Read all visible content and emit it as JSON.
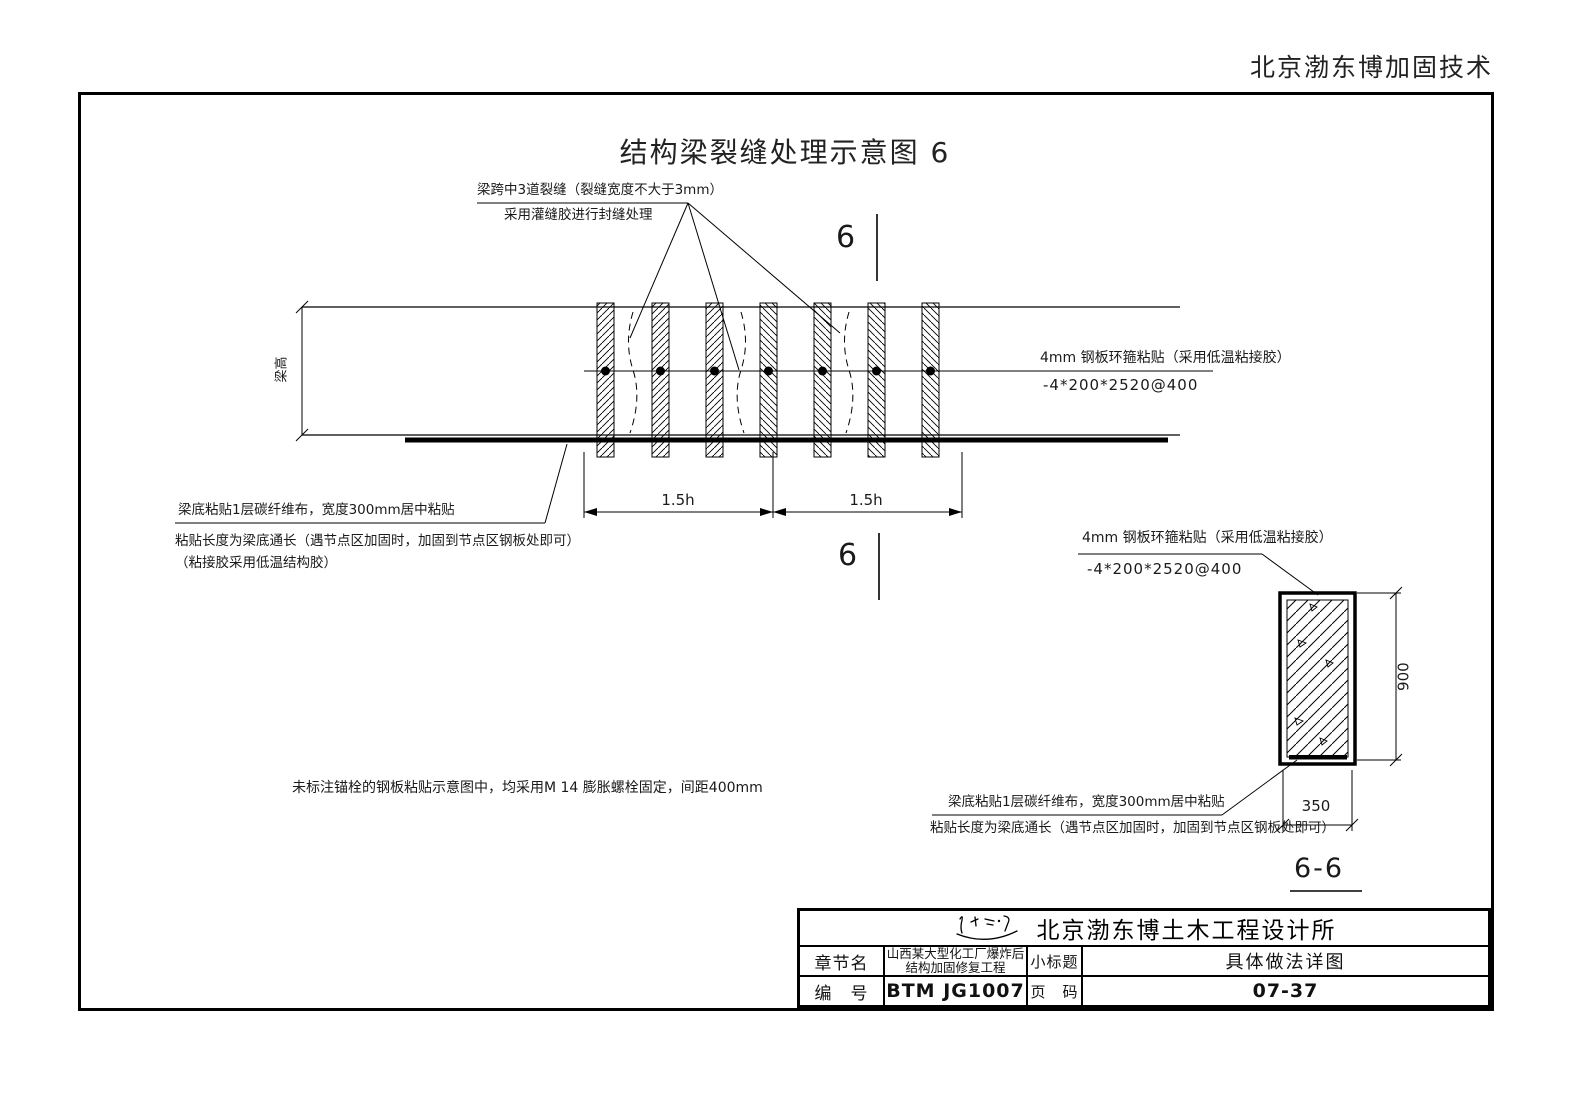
{
  "page": {
    "header_right": "北京渤东博加固技术",
    "title": "结构梁裂缝处理示意图 6",
    "background_color": "#ffffff",
    "line_color": "#000000"
  },
  "beam_view": {
    "crack_note_line1": "梁跨中3道裂缝（裂缝宽度不大于3mm）",
    "crack_note_line2": "采用灌缝胶进行封缝处理",
    "hoop_note_line1": "4mm 钢板环箍粘贴（采用低温粘接胶）",
    "hoop_note_line2": "-4*200*2520@400",
    "fiber_note_line1": "梁底粘贴1层碳纤维布，宽度300mm居中粘贴",
    "fiber_note_line2": "粘贴长度为梁底通长（遇节点区加固时，加固到节点区钢板处即可）",
    "fiber_note_line3": "（粘接胶采用低温结构胶）",
    "beam_height_label": "梁高",
    "dim_left": "1.5h",
    "dim_right": "1.5h",
    "section_mark_top": "6",
    "section_mark_bottom": "6"
  },
  "notes": {
    "anchor_note": "未标注锚栓的钢板粘贴示意图中，均采用M 14 膨胀螺栓固定，间距400mm"
  },
  "section_view": {
    "hoop_note_line1": "4mm 钢板环箍粘贴（采用低温粘接胶）",
    "hoop_note_line2": "-4*200*2520@400",
    "fiber_note_line1": "梁底粘贴1层碳纤维布，宽度300mm居中粘贴",
    "fiber_note_line2": "粘贴长度为梁底通长（遇节点区加固时，加固到节点区钢板处即可）",
    "dim_height": "900",
    "dim_width": "350",
    "label": "6-6"
  },
  "title_block": {
    "company": "北京渤东博土木工程设计所",
    "row1": {
      "label1": "章节名",
      "value1_line1": "山西某大型化工厂爆炸后",
      "value1_line2": "结构加固修复工程",
      "label2": "小标题",
      "value2": "具体做法详图"
    },
    "row2": {
      "label1": "编　号",
      "value1": "BTM JG1007",
      "label2": "页　码",
      "value2": "07-37"
    }
  }
}
